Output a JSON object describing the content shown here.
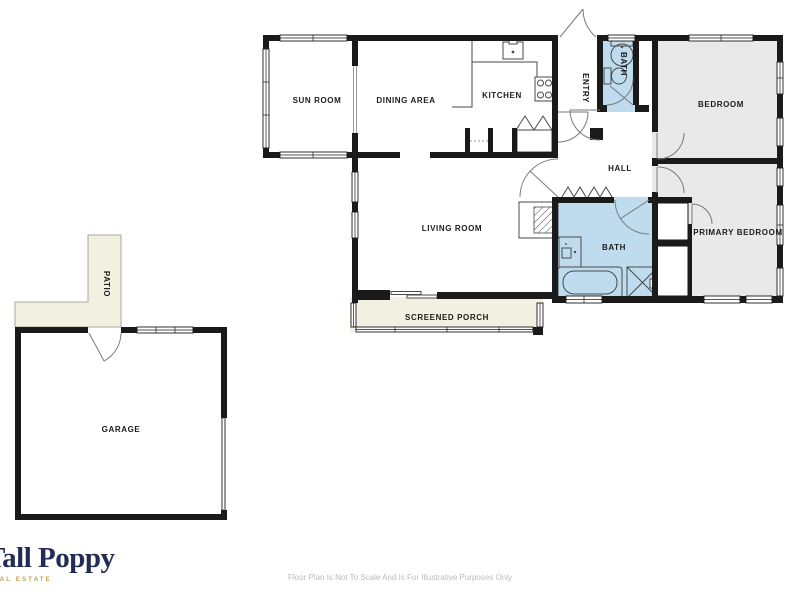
{
  "plan": {
    "rooms": {
      "sun_room": {
        "label": "SUN ROOM"
      },
      "dining_area": {
        "label": "DINING AREA"
      },
      "kitchen": {
        "label": "KITCHEN"
      },
      "entry": {
        "label": "ENTRY"
      },
      "bath_upper": {
        "label": "BATH"
      },
      "bedroom": {
        "label": "BEDROOM"
      },
      "hall": {
        "label": "HALL"
      },
      "living_room": {
        "label": "LIVING ROOM"
      },
      "bath_lower": {
        "label": "BATH"
      },
      "primary_bedroom": {
        "label": "PRIMARY BEDROOM"
      },
      "screened_porch": {
        "label": "SCREENED PORCH"
      },
      "patio": {
        "label": "PATIO"
      },
      "garage": {
        "label": "GARAGE"
      }
    },
    "fixtures": [
      "kitchen-sink",
      "stove",
      "pedestal-sink",
      "toilet",
      "vanity-sink",
      "bathtub",
      "shower",
      "fireplace",
      "bifold-closet-doors",
      "garage-door"
    ],
    "colors": {
      "wall": "#1a1a1a",
      "room_fill": "#e9e9e9",
      "bath_fill": "#bedced",
      "porch_fill": "#f2f0e0",
      "logo_navy": "#232c55",
      "logo_gold": "#bf9f4e",
      "disclaimer_gray": "#bcbcbc"
    }
  },
  "branding": {
    "logo_text": "Tall Poppy",
    "tagline": "REAL ESTATE"
  },
  "footer": {
    "disclaimer": "Floor Plan Is Not To Scale And Is For Illustrative Purposes Only"
  }
}
